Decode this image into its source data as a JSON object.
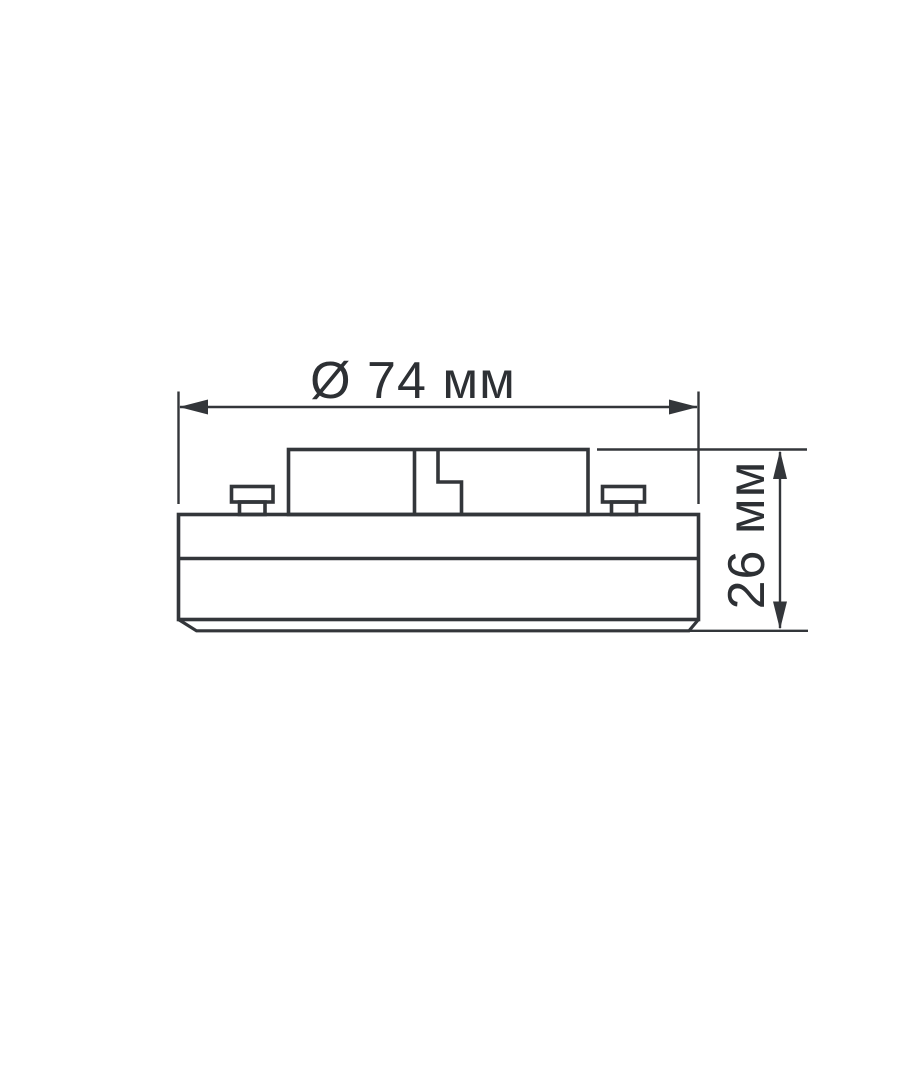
{
  "figure": {
    "type": "technical-dimension-drawing",
    "background": "#ffffff",
    "stroke_color": "#33363a",
    "text_color": "#2d3034",
    "labels": {
      "diameter": "Ø 74 мм",
      "height": "26 мм"
    },
    "values": {
      "diameter_mm": 74,
      "height_mm": 26,
      "unit": "мм"
    }
  }
}
